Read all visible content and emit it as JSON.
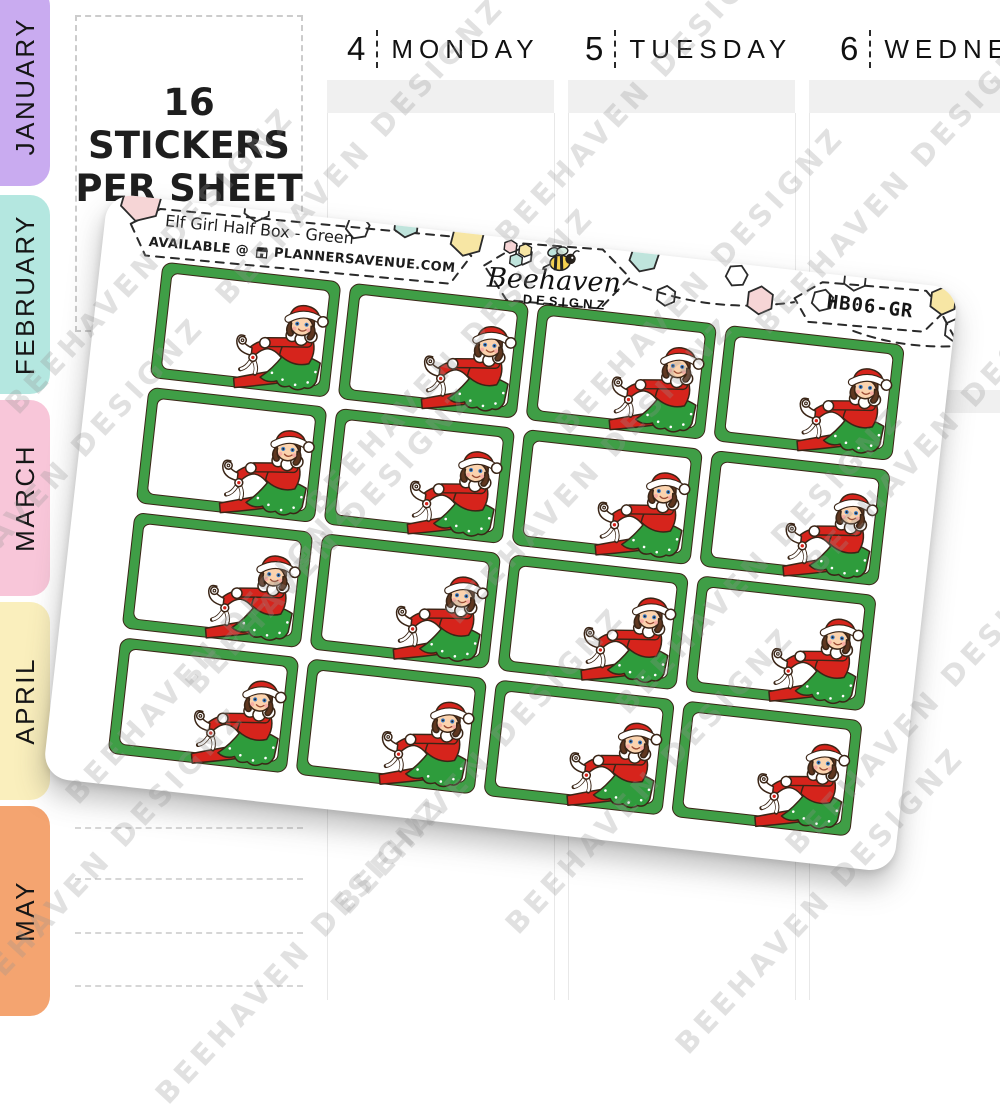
{
  "planner": {
    "months": [
      {
        "label": "JANUARY",
        "color": "#c9abf0"
      },
      {
        "label": "FEBRUARY",
        "color": "#b4e7e0"
      },
      {
        "label": "MARCH",
        "color": "#f8c6d9"
      },
      {
        "label": "APRIL",
        "color": "#faefbd"
      },
      {
        "label": "MAY",
        "color": "#f4a470"
      }
    ],
    "promo": {
      "line1": "16 STICKERS",
      "line2": "PER SHEET"
    },
    "days": [
      {
        "number": "4",
        "name": "MONDAY"
      },
      {
        "number": "5",
        "name": "TUESDAY"
      },
      {
        "number": "6",
        "name": "WEDNESDAY"
      }
    ]
  },
  "sheet": {
    "title": "Elf Girl Half Box - Green",
    "available_prefix": "AVAILABLE @",
    "available_site": "PLANNERSAVENUE.COM",
    "brand": {
      "script": "Beehaven",
      "caps": "DESIGNZ"
    },
    "sku": "HB06-GR",
    "watermark": "BEEHAVEN DESIGNZ",
    "sticker_count": 16,
    "colors": {
      "sticker_green": "#3f9e46",
      "dark_outline": "#3a2516",
      "elf_red": "#d6241c",
      "skirt_green": "#2e9c3c",
      "hex_pink": "#f6d5d6",
      "hex_teal": "#bfe4dc",
      "hex_yellow": "#f7e6a4"
    }
  }
}
